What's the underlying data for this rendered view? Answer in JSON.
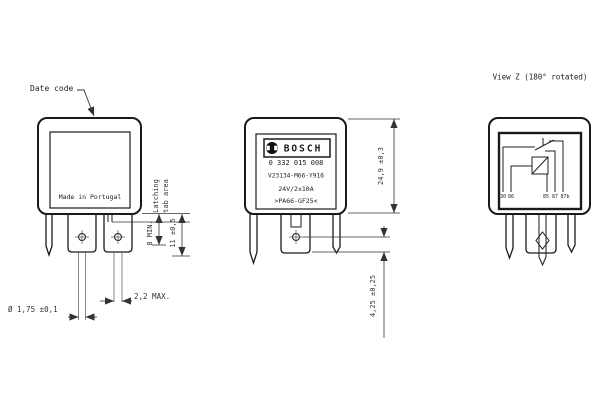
{
  "annotations": {
    "date_code": "Date code",
    "view_z_title": "View Z (180° rotated)"
  },
  "front_view": {
    "made_in": "Made in Portugal",
    "dim_latching_1": "Latching",
    "dim_latching_2": "tab area",
    "dim_8min": "8 MIN.",
    "dim_11": "11 ±0,5",
    "dim_dia": "Ø 1,75 ±0,1",
    "dim_22max": "2,2 MAX."
  },
  "label_view": {
    "brand": "BOSCH",
    "line1": "0 332 015 008",
    "line2": "V23134-M66-Y916",
    "line3": "24V/2x10A",
    "line4": ">PA66-GF25<",
    "dim_height": "24,9 ±0,3",
    "dim_pin": "4,25 ±0,25"
  },
  "view_z": {
    "pin_labels": [
      "30",
      "86",
      "85",
      "87",
      "87b"
    ]
  },
  "colors": {
    "line": "#1a1a1a",
    "dimension": "#333333",
    "background": "#ffffff"
  }
}
